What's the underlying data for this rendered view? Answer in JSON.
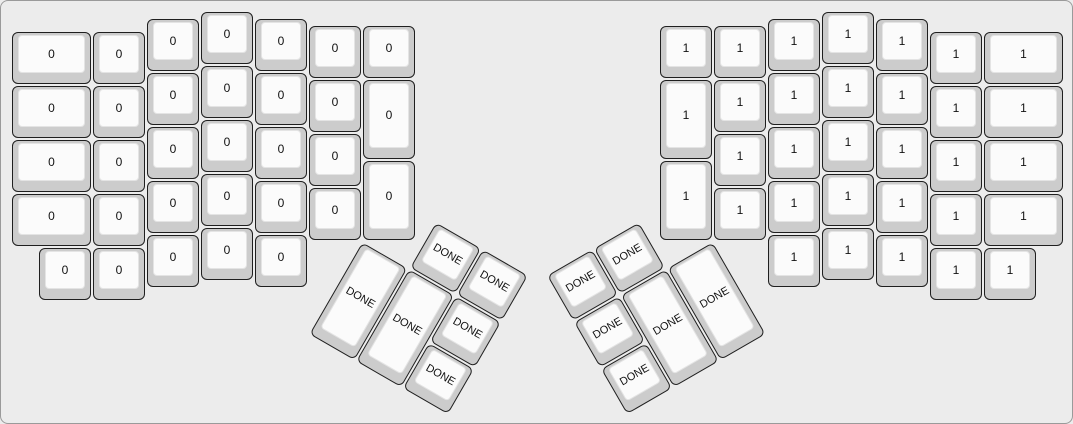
{
  "colors": {
    "canvas_bg": "#ececec",
    "canvas_border": "#9a9a9a",
    "key_body": "#cccccc",
    "key_border": "#1f1f1f",
    "keycap_top": "#fbfbfb",
    "keycap_top_border": "#e4e4e4",
    "label": "#111111"
  },
  "layout": {
    "unit_px": 54,
    "origin": {
      "x": 10,
      "y": 10
    },
    "left_main": {
      "label": "0",
      "keys": [
        [
          0,
          0.375,
          1.5,
          1
        ],
        [
          0,
          1.375,
          1.5,
          1
        ],
        [
          0,
          2.375,
          1.5,
          1
        ],
        [
          0,
          3.375,
          1.5,
          1
        ],
        [
          1.5,
          0.375,
          1,
          1
        ],
        [
          1.5,
          1.375,
          1,
          1
        ],
        [
          1.5,
          2.375,
          1,
          1
        ],
        [
          1.5,
          3.375,
          1,
          1
        ],
        [
          2.5,
          0.125,
          1,
          1
        ],
        [
          2.5,
          1.125,
          1,
          1
        ],
        [
          2.5,
          2.125,
          1,
          1
        ],
        [
          2.5,
          3.125,
          1,
          1
        ],
        [
          3.5,
          0,
          1,
          1
        ],
        [
          3.5,
          1,
          1,
          1
        ],
        [
          3.5,
          2,
          1,
          1
        ],
        [
          3.5,
          3,
          1,
          1
        ],
        [
          4.5,
          0.125,
          1,
          1
        ],
        [
          4.5,
          1.125,
          1,
          1
        ],
        [
          4.5,
          2.125,
          1,
          1
        ],
        [
          4.5,
          3.125,
          1,
          1
        ],
        [
          5.5,
          0.25,
          1,
          1
        ],
        [
          5.5,
          1.25,
          1,
          1
        ],
        [
          5.5,
          2.25,
          1,
          1
        ],
        [
          5.5,
          3.25,
          1,
          1
        ],
        [
          6.5,
          0.25,
          1,
          1
        ],
        [
          6.5,
          1.25,
          1,
          1.5
        ],
        [
          6.5,
          2.75,
          1,
          1.5
        ],
        [
          0.5,
          4.375,
          1,
          1
        ],
        [
          1.5,
          4.375,
          1,
          1
        ],
        [
          2.5,
          4.125,
          1,
          1
        ],
        [
          3.5,
          4,
          1,
          1
        ],
        [
          4.5,
          4.125,
          1,
          1
        ]
      ]
    },
    "right_main": {
      "label": "1",
      "keys": [
        [
          12,
          0.25,
          1,
          1
        ],
        [
          12,
          1.25,
          1,
          1.5
        ],
        [
          12,
          2.75,
          1,
          1.5
        ],
        [
          13,
          0.25,
          1,
          1
        ],
        [
          13,
          1.25,
          1,
          1
        ],
        [
          13,
          2.25,
          1,
          1
        ],
        [
          13,
          3.25,
          1,
          1
        ],
        [
          14,
          0.125,
          1,
          1
        ],
        [
          14,
          1.125,
          1,
          1
        ],
        [
          14,
          2.125,
          1,
          1
        ],
        [
          14,
          3.125,
          1,
          1
        ],
        [
          15,
          0,
          1,
          1
        ],
        [
          15,
          1,
          1,
          1
        ],
        [
          15,
          2,
          1,
          1
        ],
        [
          15,
          3,
          1,
          1
        ],
        [
          16,
          0.125,
          1,
          1
        ],
        [
          16,
          1.125,
          1,
          1
        ],
        [
          16,
          2.125,
          1,
          1
        ],
        [
          16,
          3.125,
          1,
          1
        ],
        [
          17,
          0.375,
          1,
          1
        ],
        [
          17,
          1.375,
          1,
          1
        ],
        [
          17,
          2.375,
          1,
          1
        ],
        [
          17,
          3.375,
          1,
          1
        ],
        [
          18,
          0.375,
          1.5,
          1
        ],
        [
          18,
          1.375,
          1.5,
          1
        ],
        [
          18,
          2.375,
          1.5,
          1
        ],
        [
          18,
          3.375,
          1.5,
          1
        ],
        [
          14,
          4.125,
          1,
          1
        ],
        [
          15,
          4,
          1,
          1
        ],
        [
          16,
          4.125,
          1,
          1
        ],
        [
          17,
          4.375,
          1,
          1
        ],
        [
          18,
          4.375,
          1,
          1
        ]
      ]
    },
    "left_thumb": {
      "label": "DONE",
      "rotation_deg": 30,
      "center_u": [
        6.5,
        4.25
      ],
      "keys": [
        [
          1,
          -1,
          1,
          1
        ],
        [
          2,
          -1,
          1,
          1
        ],
        [
          0,
          0,
          1,
          2
        ],
        [
          1,
          0,
          1,
          2
        ],
        [
          2,
          0,
          1,
          1
        ],
        [
          2,
          1,
          1,
          1
        ]
      ]
    },
    "right_thumb": {
      "label": "DONE",
      "rotation_deg": -30,
      "center_u": [
        13,
        4.25
      ],
      "keys": [
        [
          -3,
          -1,
          1,
          1
        ],
        [
          -2,
          -1,
          1,
          1
        ],
        [
          -3,
          0,
          1,
          1
        ],
        [
          -2,
          0,
          1,
          2
        ],
        [
          -1,
          0,
          1,
          2
        ],
        [
          -3,
          1,
          1,
          1
        ]
      ]
    }
  }
}
